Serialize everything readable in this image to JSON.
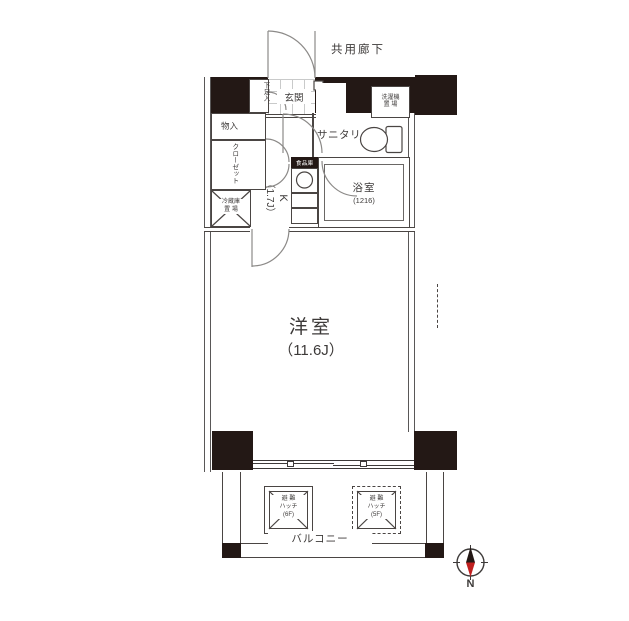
{
  "floorplan": {
    "corridor_label": "共用廊下",
    "entrance": {
      "genkan": "玄関",
      "shoe_box": "下足入"
    },
    "storage": {
      "mono_ire": "物入",
      "closet": "クローゼット",
      "fridge_line1": "冷蔵庫",
      "fridge_line2": "置 場",
      "pantry": "食品庫"
    },
    "kitchen": {
      "line1": "K",
      "line2": "（1.7J）"
    },
    "sanitary_label": "サニタリー",
    "laundry": {
      "line1": "洗濯機",
      "line2": "置 場"
    },
    "bathroom": {
      "name": "浴室",
      "size": "(1216)"
    },
    "living_room": {
      "name": "洋室",
      "size": "（11.6J）"
    },
    "balcony_label": "バルコニー",
    "hatch_left": {
      "line1": "避 難",
      "line2": "ハッチ",
      "line3": "(6F)"
    },
    "hatch_right": {
      "line1": "避 難",
      "line2": "ハッチ",
      "line3": "(5F)"
    },
    "compass_north": "N"
  },
  "colors": {
    "wall_black": "#231815",
    "line": "#4a4543",
    "tile_line": "#c9caca",
    "needle_red": "#c0201f"
  }
}
